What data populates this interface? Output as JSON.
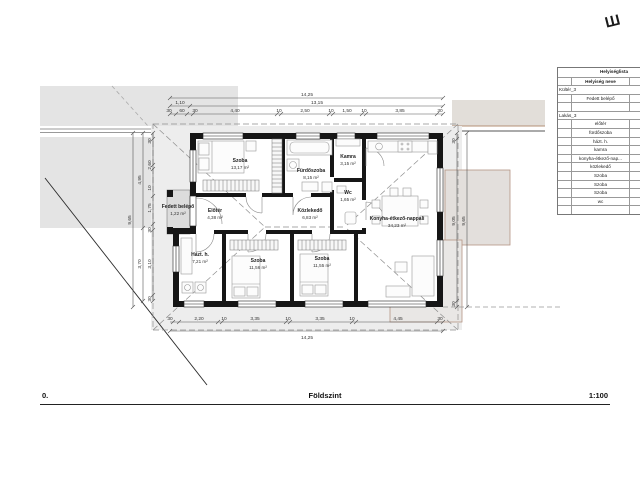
{
  "mark": "Ш",
  "title_block": {
    "number": "0.",
    "name": "Földszint",
    "scale": "1:100"
  },
  "rooms": {
    "szoba1": {
      "name": "Szoba",
      "area": "13,17 m²"
    },
    "furdoszoba": {
      "name": "Fürdőszoba",
      "area": "8,15 m²"
    },
    "kamra": {
      "name": "Kamra",
      "area": "3,15 m²"
    },
    "wc": {
      "name": "Wc",
      "area": "1,65 m²"
    },
    "fedett_belepo": {
      "name": "Fedett belépő",
      "area": "1,22 m²"
    },
    "eloter": {
      "name": "Előtér",
      "area": "4,38 m²"
    },
    "kozlekedo": {
      "name": "Közlekedő",
      "area": "6,83 m²"
    },
    "konyha": {
      "name": "Konyha-étkező-nappali",
      "area": "34,23 m²"
    },
    "hazt": {
      "name": "Házt. h.",
      "area": "7,21 m²"
    },
    "szoba2": {
      "name": "Szoba",
      "area": "11,56 m²"
    },
    "szoba3": {
      "name": "Szoba",
      "area": "11,55 m²"
    }
  },
  "dims": {
    "top_overall": "14,25",
    "top_left": "1,10",
    "top_main": "13,15",
    "top_segs": [
      "30",
      "60",
      "30",
      "4,40",
      "10",
      "2,50",
      "10",
      "1,50",
      "10",
      "3,85",
      "30"
    ],
    "bottom_segs": [
      "30",
      "2,20",
      "10",
      "3,35",
      "10",
      "3,35",
      "10",
      "4,45",
      "30"
    ],
    "bottom_overall": "14,25",
    "left_outer": "9,65",
    "left_mid": [
      "4,95",
      "3,70"
    ],
    "left_segs": [
      "30",
      "2,60",
      "10",
      "1,75",
      "30",
      "3,10",
      "30"
    ],
    "right_segs": [
      "30",
      "9,05",
      "30"
    ],
    "right_outer": "9,65"
  },
  "table": {
    "title": "Helyiséglista",
    "col_name": "Helyiség neve",
    "col_area": "Te",
    "rows": [
      {
        "name": "Kültér_3",
        "value": ""
      },
      {
        "name": "Fedett belépő",
        "value": ""
      },
      {
        "name": "",
        "value": "1,"
      },
      {
        "name": "Lakás_3",
        "value": ""
      },
      {
        "name": "előtér",
        "value": ""
      },
      {
        "name": "fürdőszoba",
        "value": ""
      },
      {
        "name": "házt. h.",
        "value": ""
      },
      {
        "name": "kamra",
        "value": ""
      },
      {
        "name": "konyha-étkező-nap...",
        "value": ""
      },
      {
        "name": "közlekedő",
        "value": ""
      },
      {
        "name": "Szoba",
        "value": ""
      },
      {
        "name": "Szoba",
        "value": ""
      },
      {
        "name": "Szoba",
        "value": ""
      },
      {
        "name": "wc",
        "value": ""
      },
      {
        "name": "",
        "value": "100"
      }
    ]
  }
}
